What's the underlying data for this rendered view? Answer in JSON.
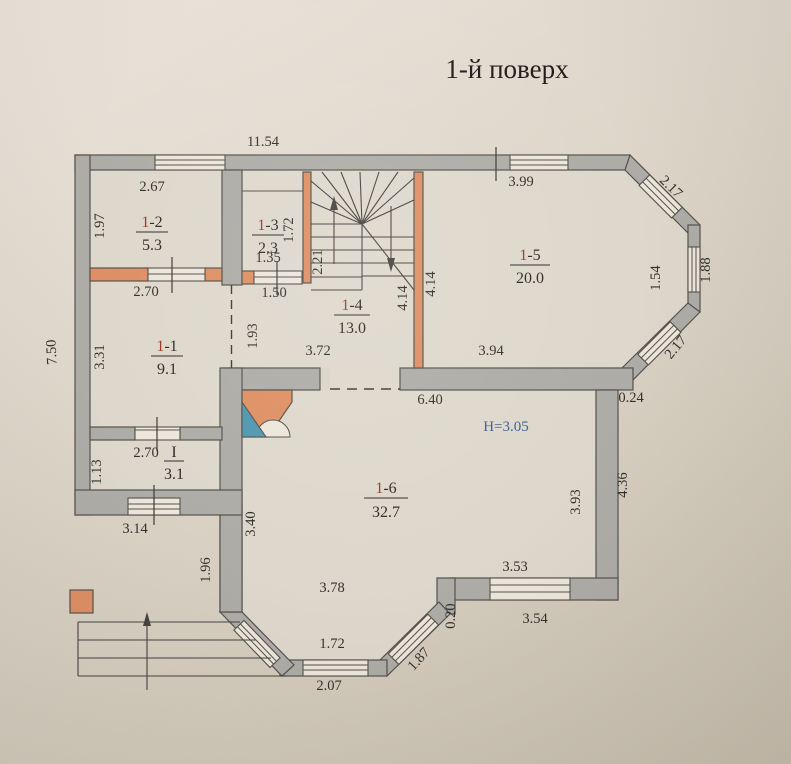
{
  "title": "1-й поверх",
  "palette": {
    "paper": "#d9d2c5",
    "wall_gray": "#aeaca7",
    "partition_orange": "#de8f63",
    "room_number_red": "#a03a28",
    "height_note_blue": "#3c5f94",
    "fireplace_teal": "#4f97b0"
  },
  "rooms": {
    "r11": {
      "prefix": "1",
      "rest": "-1",
      "area": "9.1"
    },
    "r12": {
      "prefix": "1",
      "rest": "-2",
      "area": "5.3"
    },
    "r13": {
      "prefix": "1",
      "rest": "-3",
      "area": "2.3"
    },
    "r14": {
      "prefix": "1",
      "rest": "-4",
      "area": "13.0"
    },
    "r15": {
      "prefix": "1",
      "rest": "-5",
      "area": "20.0"
    },
    "r16": {
      "prefix": "1",
      "rest": "-6",
      "area": "32.7"
    },
    "rI": {
      "prefix": "",
      "rest": "I",
      "area": "3.1"
    }
  },
  "dims": {
    "overall_top": "11.54",
    "overall_left": "7.50",
    "r12_top": "2.67",
    "r12_left": "1.97",
    "r12_bottom": "2.70",
    "r13_win": "1.35",
    "r13_bottom": "1.50",
    "r13_right": "1.72",
    "stairs_flight": "2.21",
    "hall_opening": "1.93",
    "r11_left": "3.31",
    "rI_top": "2.70",
    "rI_left": "1.13",
    "r14_bottom": "3.72",
    "r14_right": "4.14",
    "r15_left": "4.14",
    "r15_top": "3.99",
    "bay_top_diag": "2.17",
    "bay_right_outer": "1.88",
    "bay_right_inner": "1.54",
    "bay_bottom_diag": "2.17",
    "r15_bottom": "3.94",
    "corner_offset": "0.24",
    "r16_top": "6.40",
    "height_note": "H=3.05",
    "r16_right_inner": "3.93",
    "r16_right_outer": "4.36",
    "r16_win_bottom": "3.53",
    "r16_bottom": "3.54",
    "step_offset": "0.20",
    "bay2_width": "3.78",
    "bay2_win": "1.72",
    "bay2_bottom": "2.07",
    "bay2_diag": "1.87",
    "r16_left": "3.40",
    "porch_right": "1.96",
    "porch_top": "3.14"
  }
}
